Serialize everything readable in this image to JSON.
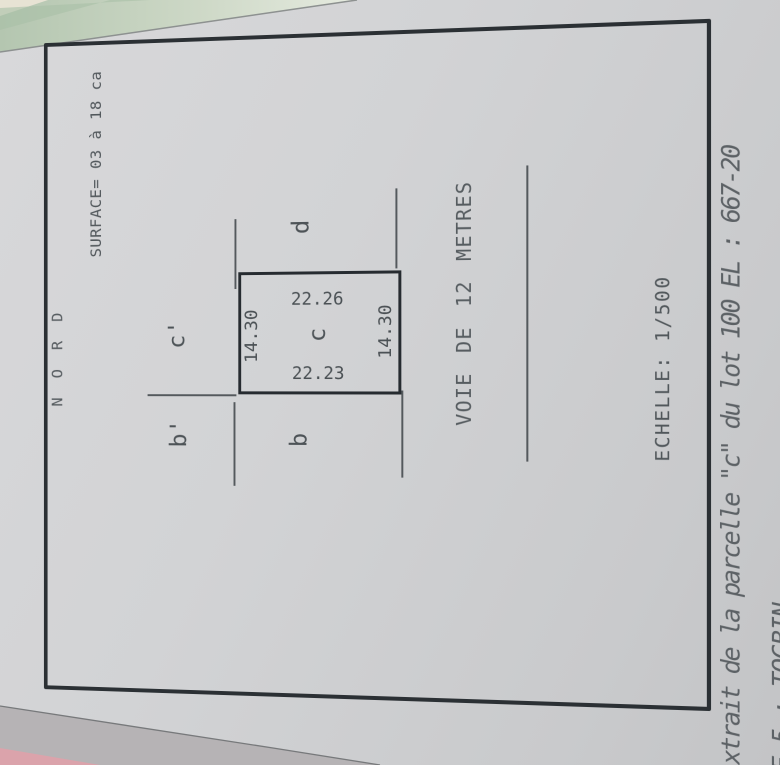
{
  "plan": {
    "north_label": "N O R D",
    "surface_label": "SURFACE= 03 à 18 ca",
    "scale_label": "ECHELLE: 1/500",
    "road_label": "VOIE DE 12 METRES",
    "parcel": {
      "label": "c",
      "dim_top": "14.30",
      "dim_bottom": "14.30",
      "dim_left": "22.23",
      "dim_right": "22.26"
    },
    "neighbors": {
      "left": "b",
      "top_left": "b'",
      "top": "c'",
      "right": "d"
    }
  },
  "footer": {
    "line1": "xtrait de la parcelle \"c\" du lot 100 EL : 667-20",
    "line2": "NE 5 : TOGBIN"
  },
  "colors": {
    "paper": "#cfd0d2",
    "ink_bold": "#2a2f34",
    "ink_thin": "#4d5357",
    "background_green": "#bccab6",
    "background_pink": "#dba3ab"
  }
}
